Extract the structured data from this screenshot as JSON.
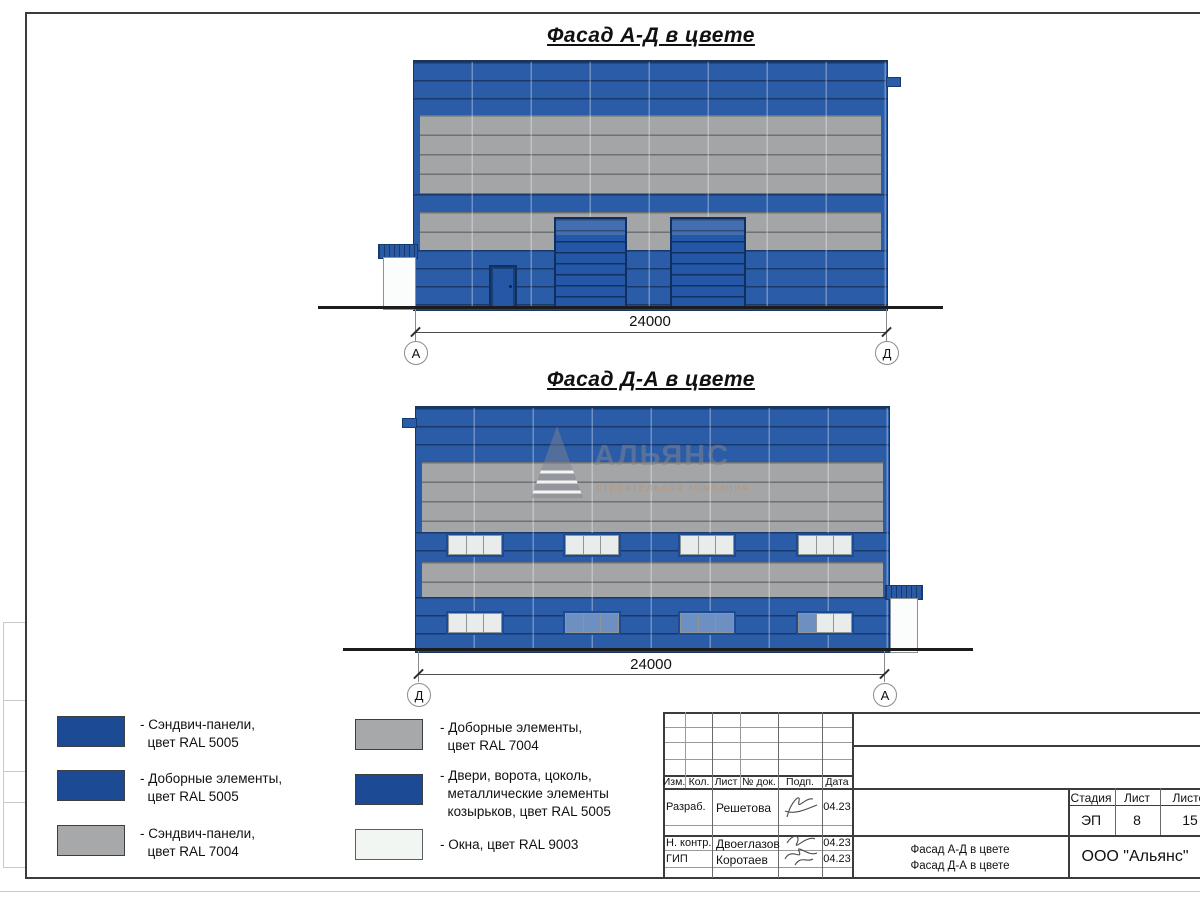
{
  "titles": {
    "facade_ad": "Фасад А-Д в цвете",
    "facade_da": "Фасад Д-А в цвете"
  },
  "dimensions": {
    "facade_ad": {
      "length": "24000",
      "axis_left": "А",
      "axis_right": "Д"
    },
    "facade_da": {
      "length": "24000",
      "axis_left": "Д",
      "axis_right": "А"
    }
  },
  "watermark": {
    "name": "АЛЬЯНС",
    "tagline": "строительная компания"
  },
  "legend": {
    "left": [
      {
        "label": "- Сэндвич-панели,\n  цвет RAL 5005",
        "color": "#1d4a95"
      },
      {
        "label": "- Доборные элементы,\n  цвет RAL 5005",
        "color": "#1d4a95"
      },
      {
        "label": "- Сэндвич-панели,\n  цвет RAL 7004",
        "color": "#a6a8aa"
      }
    ],
    "right": [
      {
        "label": "- Доборные элементы,\n  цвет RAL 7004",
        "color": "#a6a8aa"
      },
      {
        "label": "- Двери, ворота, цоколь,\n  металлические элементы\n  козырьков, цвет RAL 5005",
        "color": "#1d4a95"
      },
      {
        "label": "- Окна, цвет RAL 9003",
        "color": "#f2f6f3"
      }
    ]
  },
  "title_block": {
    "rev_columns": [
      "Изм.",
      "Кол.",
      "Лист",
      "№ док.",
      "Подп.",
      "Дата"
    ],
    "rows": [
      {
        "role": "Разраб.",
        "name": "Решетова",
        "date": "04.23"
      },
      {
        "role": "Н. контр.",
        "name": "Двоеглазов",
        "date": "04.23"
      },
      {
        "role": "ГИП",
        "name": "Коротаев",
        "date": "04.23"
      }
    ],
    "stage_label": "Стадия",
    "sheet_label": "Лист",
    "sheets_label": "Листов",
    "stage": "ЭП",
    "sheet_number": "8",
    "sheets_total": "15",
    "drawing_title": "Фасад А-Д в цвете\nФасад Д-А в цвете",
    "company": "ООО \"Альянс\""
  },
  "colors": {
    "panel_blue_ral5005": "#2b5ca7",
    "panel_gray_ral7004": "#a3a5a7",
    "details_navy_ral5005": "#1d4a95",
    "window_white_ral9003": "#eef2f0",
    "glass_blue": "#6d8fc2"
  }
}
